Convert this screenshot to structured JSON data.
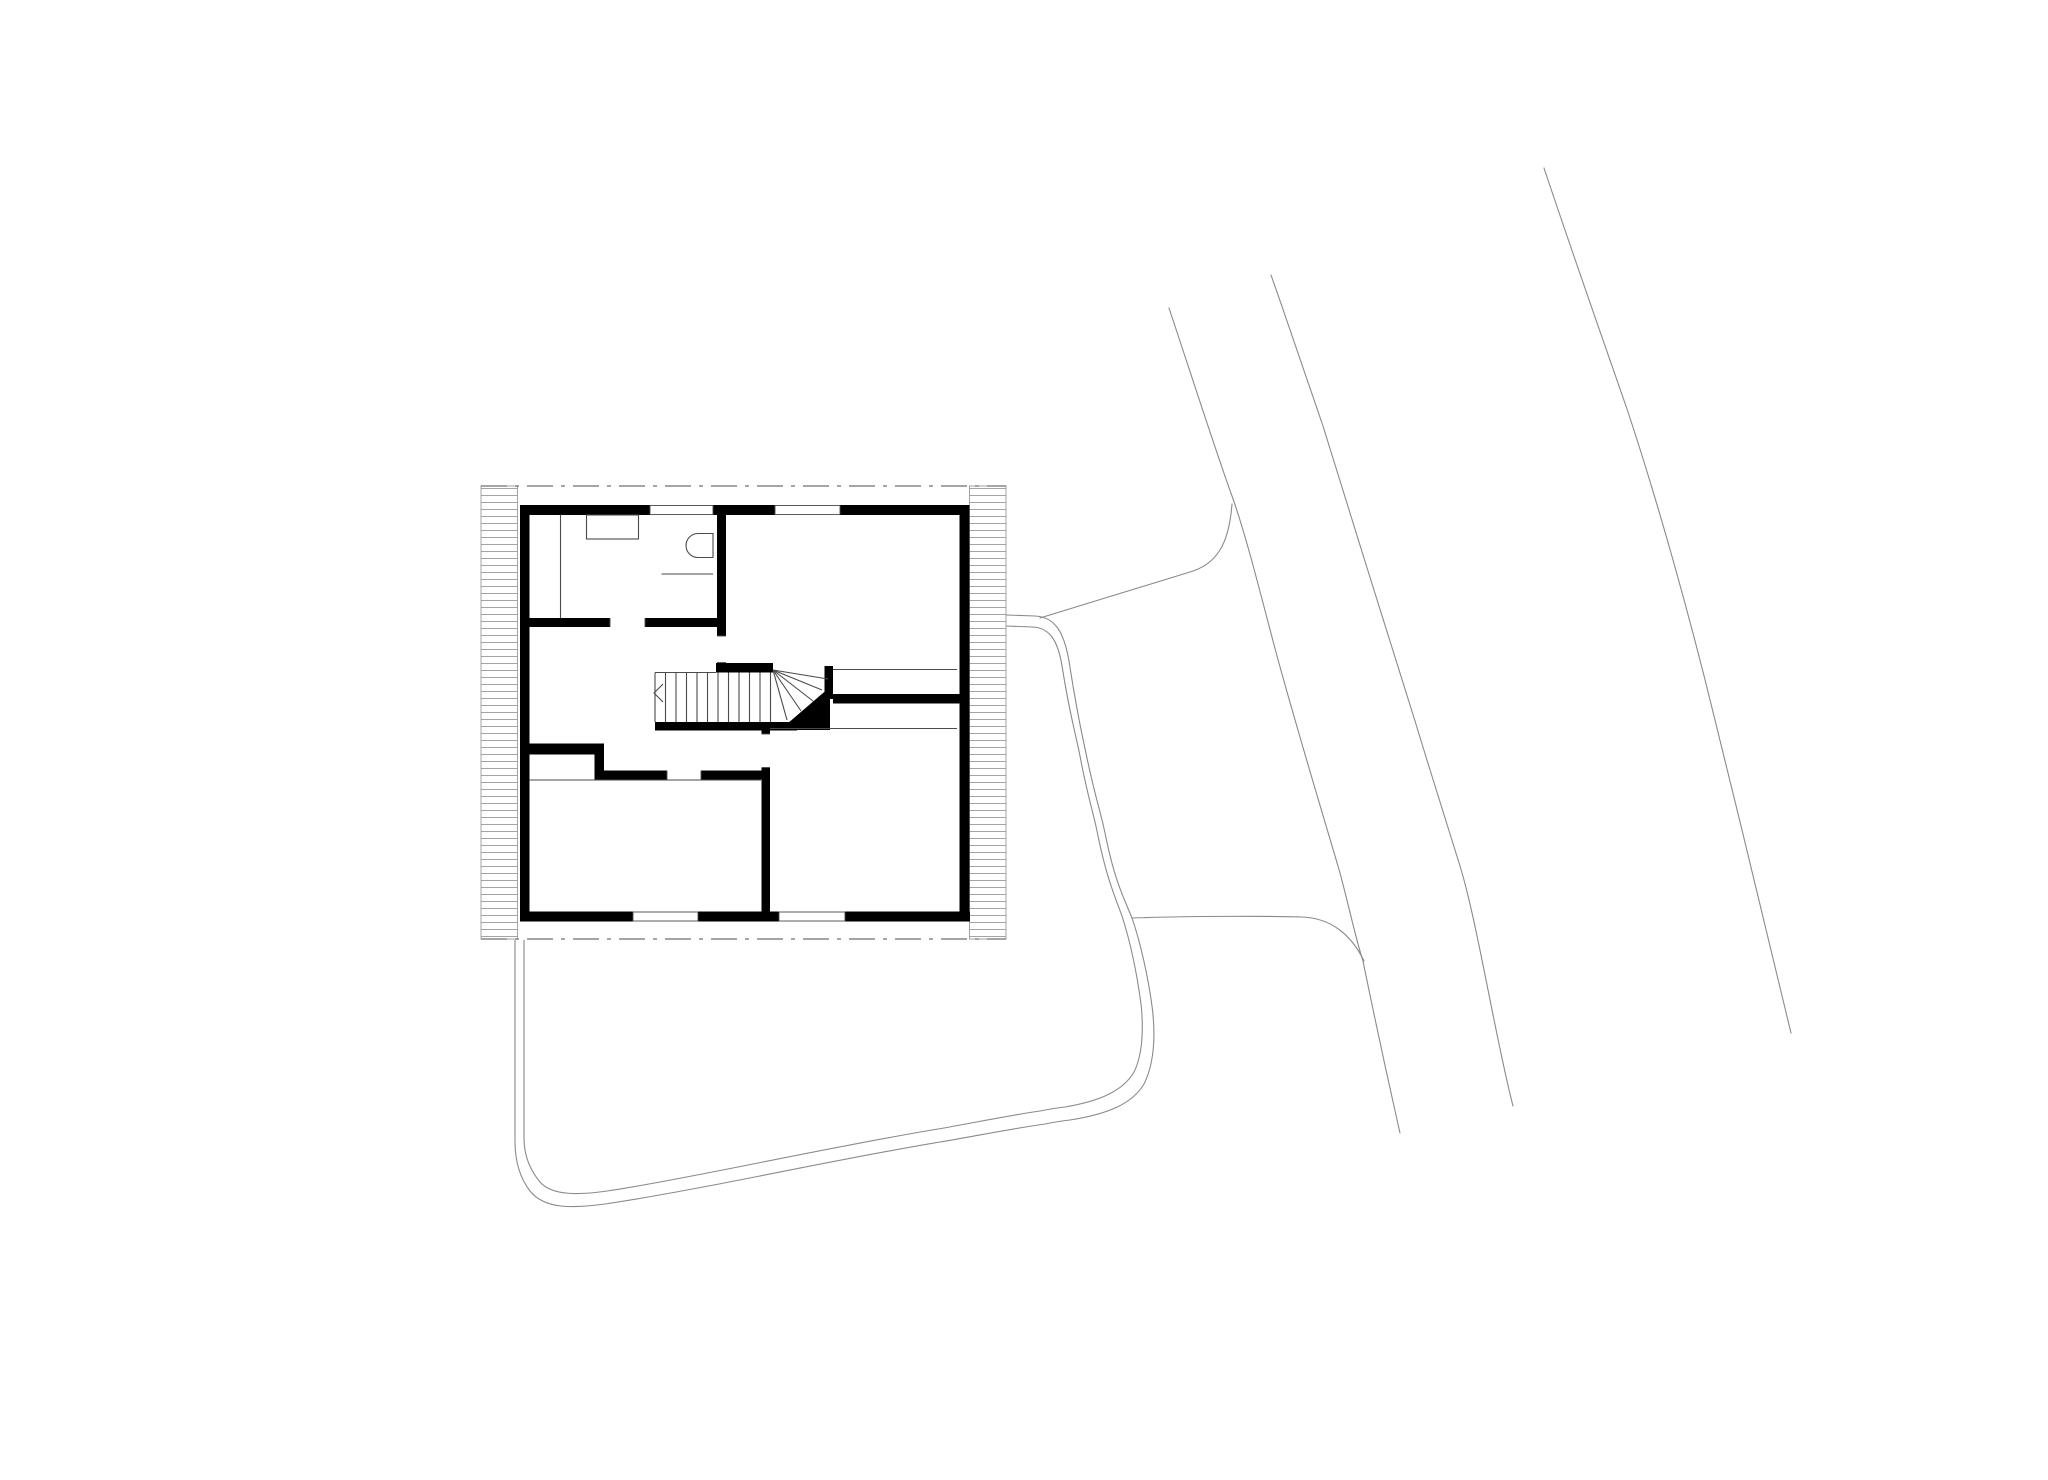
{
  "meta": {
    "title": "architectural-floor-plan",
    "description": "Black-and-white upper floor plan of a small square house with winder stair, shown with site context: curved road edge lines to the right and a looping driveway path around the south side of the building.",
    "canvas": {
      "width": 2048,
      "height": 1448
    }
  },
  "colors": {
    "background": "#ffffff",
    "wall": "#000000",
    "thin_line": "#4a4a4a",
    "site_line": "#8a8a8a",
    "hatch_line": "#9a9a9a",
    "hatch_outline": "#9a9a9a",
    "dash_line": "#6f6f6f",
    "window_line": "#4a4a4a"
  },
  "plan": {
    "rooms": [
      {
        "name": "bathroom",
        "position": "top-left",
        "fixtures": [
          "washbasin-counter",
          "wc"
        ]
      },
      {
        "name": "room-top-right",
        "position": "top-right"
      },
      {
        "name": "hall-landing",
        "position": "center-left"
      },
      {
        "name": "room-bottom-left",
        "position": "bottom-left"
      },
      {
        "name": "room-bottom-right",
        "position": "bottom-right"
      }
    ],
    "stair": {
      "type": "straight-run-with-winders",
      "straight_treads": 12,
      "winder_treads": 5,
      "direction_marker": "chevron-at-start"
    },
    "site": {
      "road_edge_lines": 3,
      "driveway": "double-line loop from east side around south to west side",
      "roof_overhang": "dash-dot lines top and bottom, hatched eave bands left and right"
    }
  },
  "drawing": {
    "stroke": {
      "thin": 1.1,
      "site": 1.1,
      "hatch": 0.9,
      "dash": 1.3,
      "window": 0.9
    },
    "dash_pattern": "26 8 4 8",
    "hatch_bands": [
      [
        441,
        470,
        36.5,
        453
      ],
      [
        929.5,
        470,
        36.5,
        453
      ]
    ],
    "dash_lines": [
      [
        441,
        470,
        966,
        470
      ],
      [
        441,
        923,
        966,
        923
      ]
    ],
    "walls": [
      [
        480,
        489,
        130,
        10
      ],
      [
        673,
        489,
        62,
        10
      ],
      [
        800,
        489,
        120,
        10
      ],
      [
        480,
        489,
        9.5,
        416.5
      ],
      [
        919.5,
        489,
        10,
        416.5
      ],
      [
        480,
        895.5,
        113,
        10
      ],
      [
        658,
        895.5,
        81,
        10
      ],
      [
        805,
        895.5,
        125,
        10
      ],
      [
        489,
        602,
        81,
        9
      ],
      [
        605,
        602,
        72.5,
        9
      ],
      [
        677,
        498,
        9,
        122
      ],
      [
        676,
        647,
        57,
        9.5
      ],
      [
        615,
        706,
        142,
        8.5
      ],
      [
        784.5,
        650,
        8.5,
        33
      ],
      [
        793,
        678,
        127,
        9.5
      ],
      [
        487,
        727.5,
        76,
        11
      ],
      [
        554.5,
        727.5,
        9.5,
        36
      ],
      [
        563,
        754.5,
        64,
        9
      ],
      [
        661,
        754.5,
        69,
        9
      ],
      [
        721.5,
        706.5,
        8.5,
        11.5
      ],
      [
        721.5,
        751.5,
        8.5,
        144
      ]
    ],
    "winder_fill": "740,714 790,671 790,714",
    "windows": [
      [
        610,
        489.5,
        63,
        9
      ],
      [
        735,
        489.5,
        65,
        9
      ],
      [
        593,
        896,
        65,
        9
      ],
      [
        739,
        896,
        66,
        9
      ]
    ],
    "door_jambs": [
      [
        570,
        602,
        570,
        611
      ],
      [
        605,
        602,
        605,
        611
      ],
      [
        677,
        620,
        686,
        620
      ],
      [
        677,
        646.5,
        686,
        646.5
      ],
      [
        627,
        754.5,
        627,
        763.5
      ],
      [
        661,
        754.5,
        661,
        763.5
      ],
      [
        721.5,
        718,
        730,
        718
      ],
      [
        721.5,
        751.5,
        730,
        751.5
      ]
    ],
    "thin_lines": [
      [
        520.5,
        498.5,
        520.5,
        602
      ],
      [
        621.5,
        558,
        673,
        558
      ],
      [
        793,
        653.5,
        917,
        653.5
      ],
      [
        730,
        712.5,
        917,
        712.5
      ],
      [
        489,
        764,
        721,
        764
      ],
      [
        615,
        656.5,
        676,
        656.5
      ],
      [
        615,
        656.5,
        615,
        706
      ]
    ],
    "treads": {
      "xs": [
        625.5,
        636,
        646.5,
        657,
        667.5,
        678,
        688.5,
        699,
        709.5,
        720,
        730.5
      ],
      "y1": 656.5,
      "y2": 706
    },
    "winder_lines": [
      [
        733,
        654,
        747,
        704
      ],
      [
        733,
        654,
        761,
        695
      ],
      [
        733,
        654,
        773,
        685
      ],
      [
        733,
        654,
        782,
        674
      ],
      [
        733,
        654,
        788,
        663
      ]
    ],
    "chevron": "623,668 614,677 623,686",
    "basin": [
      546.5,
      499,
      52,
      24
    ],
    "toilet_path": "M673,517.5 H658 A12,12 0 0 0 658,541.5 H673 Z",
    "site_paths": [
      "M1129,292 C1150,355 1178,442 1192,480 C1207,522 1222,584 1237,640 C1257,713 1282,796 1298,850 C1306,877 1315,921 1323,945 C1335,1004 1348,1064 1360,1117",
      "M1231,259 C1250,313 1270,371 1283,410 C1313,506 1345,611 1375,705 C1390,754 1406,806 1420,850 C1437,905 1456,1025 1473,1090",
      "M1504,152 C1532,236 1562,321 1587,393 C1617,483 1650,601 1674,700 C1700,806 1731,931 1751,1017",
      "M1000,602 L1150,556 C1177,548 1189,528 1192,488",
      "M1092,902 C1150,900 1230,900 1262,901 C1292,902 1312,920 1324,945"
    ],
    "driveway_paths": [
      "M966,599 L995,600 C1015,601 1024,616 1029,645 C1038,703 1042,718 1047,742 C1056,785 1062,800 1066,822 C1075,865 1083,880 1092,902 C1100,925 1108,960 1112,990 C1116,1020 1114,1048 1104,1068 C1092,1088 1068,1098 1030,1104 C1020,1105 1015,1106 1005,1108 C970,1113 930,1121 900,1126 C840,1136 780,1148 720,1160 C670,1170 600,1183 565,1188 C535,1192 505,1194 490,1175 C480,1162 475,1145 475,1125 L475,924",
      "M966,610 L993,611 C1010,612 1018,625 1022,650 C1030,700 1035,715 1040,740 C1048,783 1054,798 1058,820 C1067,863 1074,878 1082,900 C1090,925 1097,958 1101,988 C1104,1015 1102,1040 1094,1056 C1083,1075 1060,1085 1025,1091 C1015,1092 1010,1093 1000,1095 C965,1100 928,1108 898,1113 C838,1123 778,1135 718,1147 C668,1157 602,1170 567,1175 C540,1179 512,1180 500,1166 C490,1154 484,1140 484,1122 L484,924"
    ]
  }
}
